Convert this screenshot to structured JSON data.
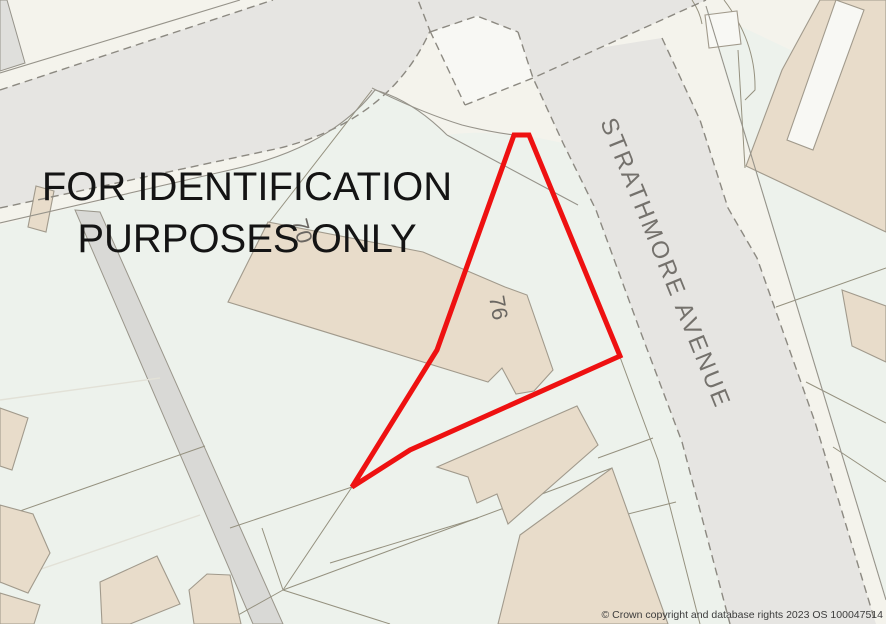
{
  "caption": {
    "line1": "FOR IDENTIFICATION",
    "line2": "PURPOSES ONLY"
  },
  "map": {
    "street_name": "STRATHMORE AVENUE",
    "plots": {
      "plot_76": "76",
      "plot_70": "70"
    }
  },
  "attribution": "© Crown copyright and database rights 2023 OS 100047514",
  "colors": {
    "site_boundary_red": "#ee1111",
    "building_fill": "#e8dcca",
    "road_fill": "#e6e5e2",
    "parcel_fill": "#edf2ec",
    "background_cream": "#f4f3ec",
    "track_fill": "#d9d9d6",
    "street_label_gray": "#74716c",
    "caption_black": "#141414"
  }
}
